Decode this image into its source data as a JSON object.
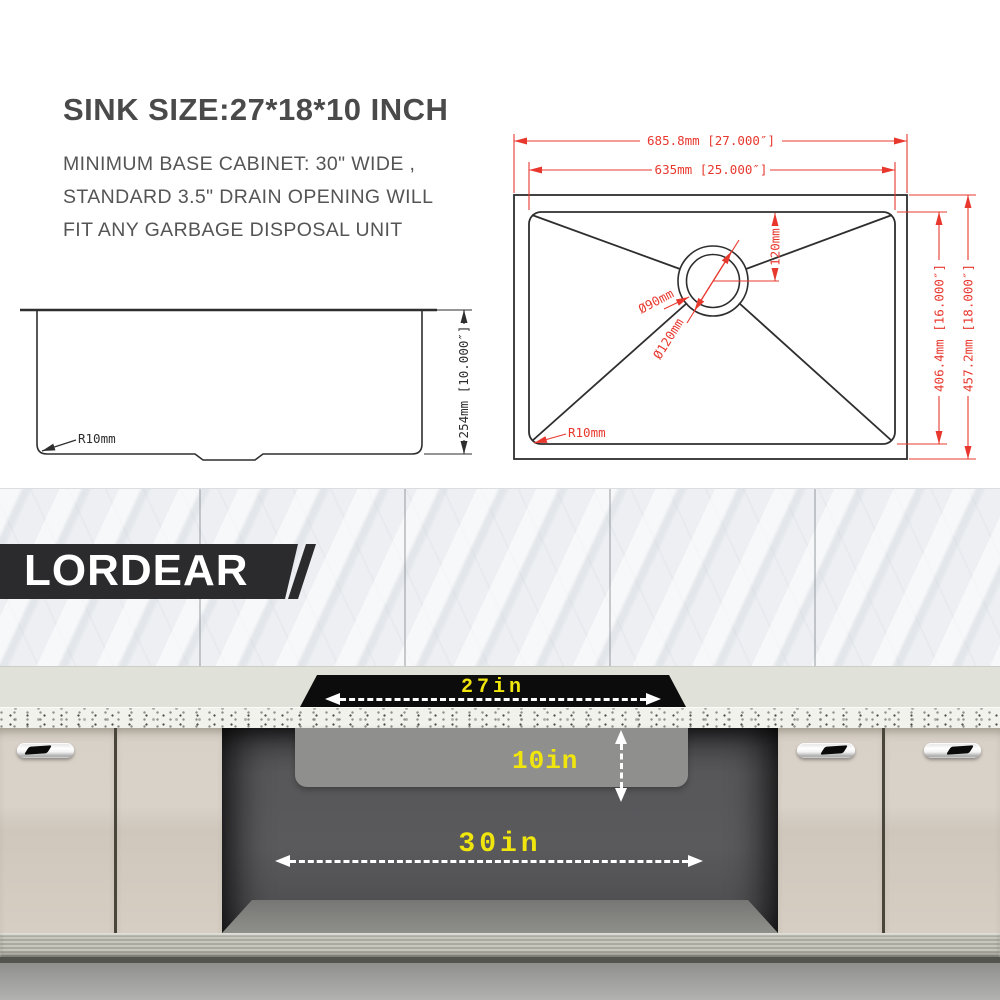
{
  "header": {
    "title": "SINK SIZE:27*18*10 INCH",
    "subtitle": [
      "MINIMUM BASE CABINET: 30\" WIDE ,",
      "STANDARD 3.5\" DRAIN OPENING WILL",
      "FIT ANY GARBAGE DISPOSAL UNIT"
    ]
  },
  "brand": {
    "name": "LORDEAR"
  },
  "side_view": {
    "height_dim": "254mm [10.000″]",
    "corner_radius": "R10mm"
  },
  "top_view": {
    "outer_width": "685.8mm [27.000″]",
    "basin_width": "635mm [25.000″]",
    "basin_depth": "406.4mm [16.000″]",
    "outer_depth": "457.2mm [18.000″]",
    "drain_offset": "120mm",
    "drain_inner": "Ø90mm",
    "drain_outer": "Ø120mm",
    "corner_radius": "R10mm"
  },
  "installation": {
    "sink_width": "27in",
    "sink_depth": "10in",
    "cabinet_width": "30in"
  },
  "colors": {
    "dimension_red": "#e8382e",
    "drawing_black": "#2e2e2e",
    "label_yellow": "#f0e50c",
    "banner_dark": "#2b2b2e"
  }
}
